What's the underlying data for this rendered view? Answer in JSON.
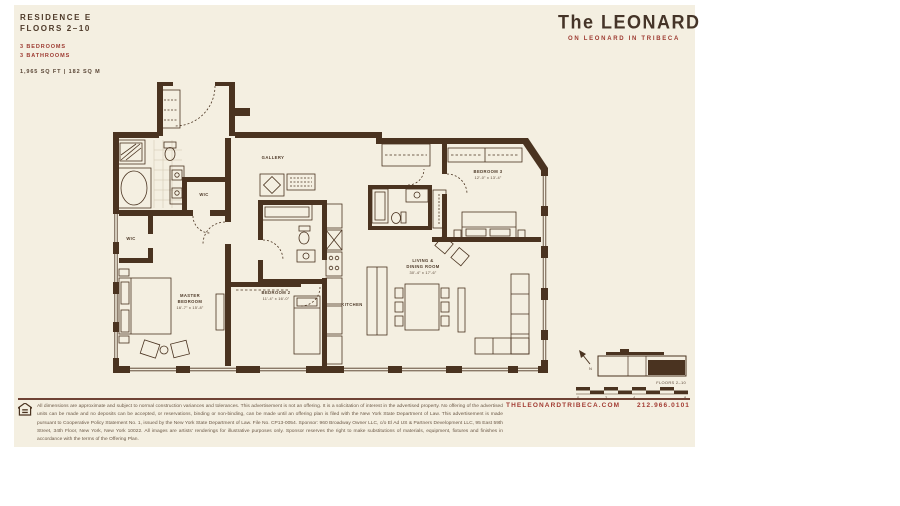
{
  "colors": {
    "panel": "#f4efe1",
    "wall": "#4a3320",
    "accent_red": "#9d3a31",
    "text_brown": "#4e3a29"
  },
  "header": {
    "residence": "RESIDENCE E",
    "floors": "FLOORS 2–10",
    "bedrooms": "3 BEDROOMS",
    "bathrooms": "3 BATHROOMS",
    "area": "1,965 SQ FT | 182 SQ M"
  },
  "brand": {
    "name": "The LEONARD",
    "tagline": "ON LEONARD IN TRIBECA"
  },
  "plan": {
    "gallery": "GALLERY",
    "kitchen": "KITCHEN",
    "wic_upper": "WIC",
    "wic_lower": "WIC",
    "wd": "W/D",
    "master_l1": "MASTER",
    "master_l2": "BEDROOM",
    "master_dims": "16'-7\" x 15'-8\"",
    "bedroom2_name": "BEDROOM 2",
    "bedroom2_dims": "11'-4\" x 16'-0\"",
    "bedroom3_name": "BEDROOM 3",
    "bedroom3_dims": "12'-0\" x 13'-4\"",
    "living_l1": "LIVING &",
    "living_l2": "DINING ROOM",
    "living_dims": "30'-4\" x 17'-6\""
  },
  "keyplan": {
    "north": "N",
    "label": "FLOORS 2–10",
    "scale_ticks": [
      "0",
      "2",
      "4",
      "8"
    ]
  },
  "footer": {
    "disclaimer": "All dimensions are approximate and subject to normal construction variances and tolerances. This advertisement is not an offering. It is a solicitation of interest in the advertised property. No offering of the advertised units can be made and no deposits can be accepted, or reservations, binding or non-binding, can be made until an offering plan is filed with the New York State Department of Law. This advertisement is made pursuant to Cooperative Policy Statement No. 1, issued by the New York State Department of Law. File No. CP13-0054. Sponsor: 960 Broadway Owner LLC, c/o El Ad US & Partners Development LLC, 95 East 59th Street, 34th Floor, New York, New York 10022. All images are artists' renderings for illustrative purposes only. Sponsor reserves the right to make substitutions of materials, equipment, fixtures and finishes in accordance with the terms of the Offering Plan.",
    "website": "THELEONARDTRIBECA.COM",
    "phone": "212.966.0101"
  }
}
